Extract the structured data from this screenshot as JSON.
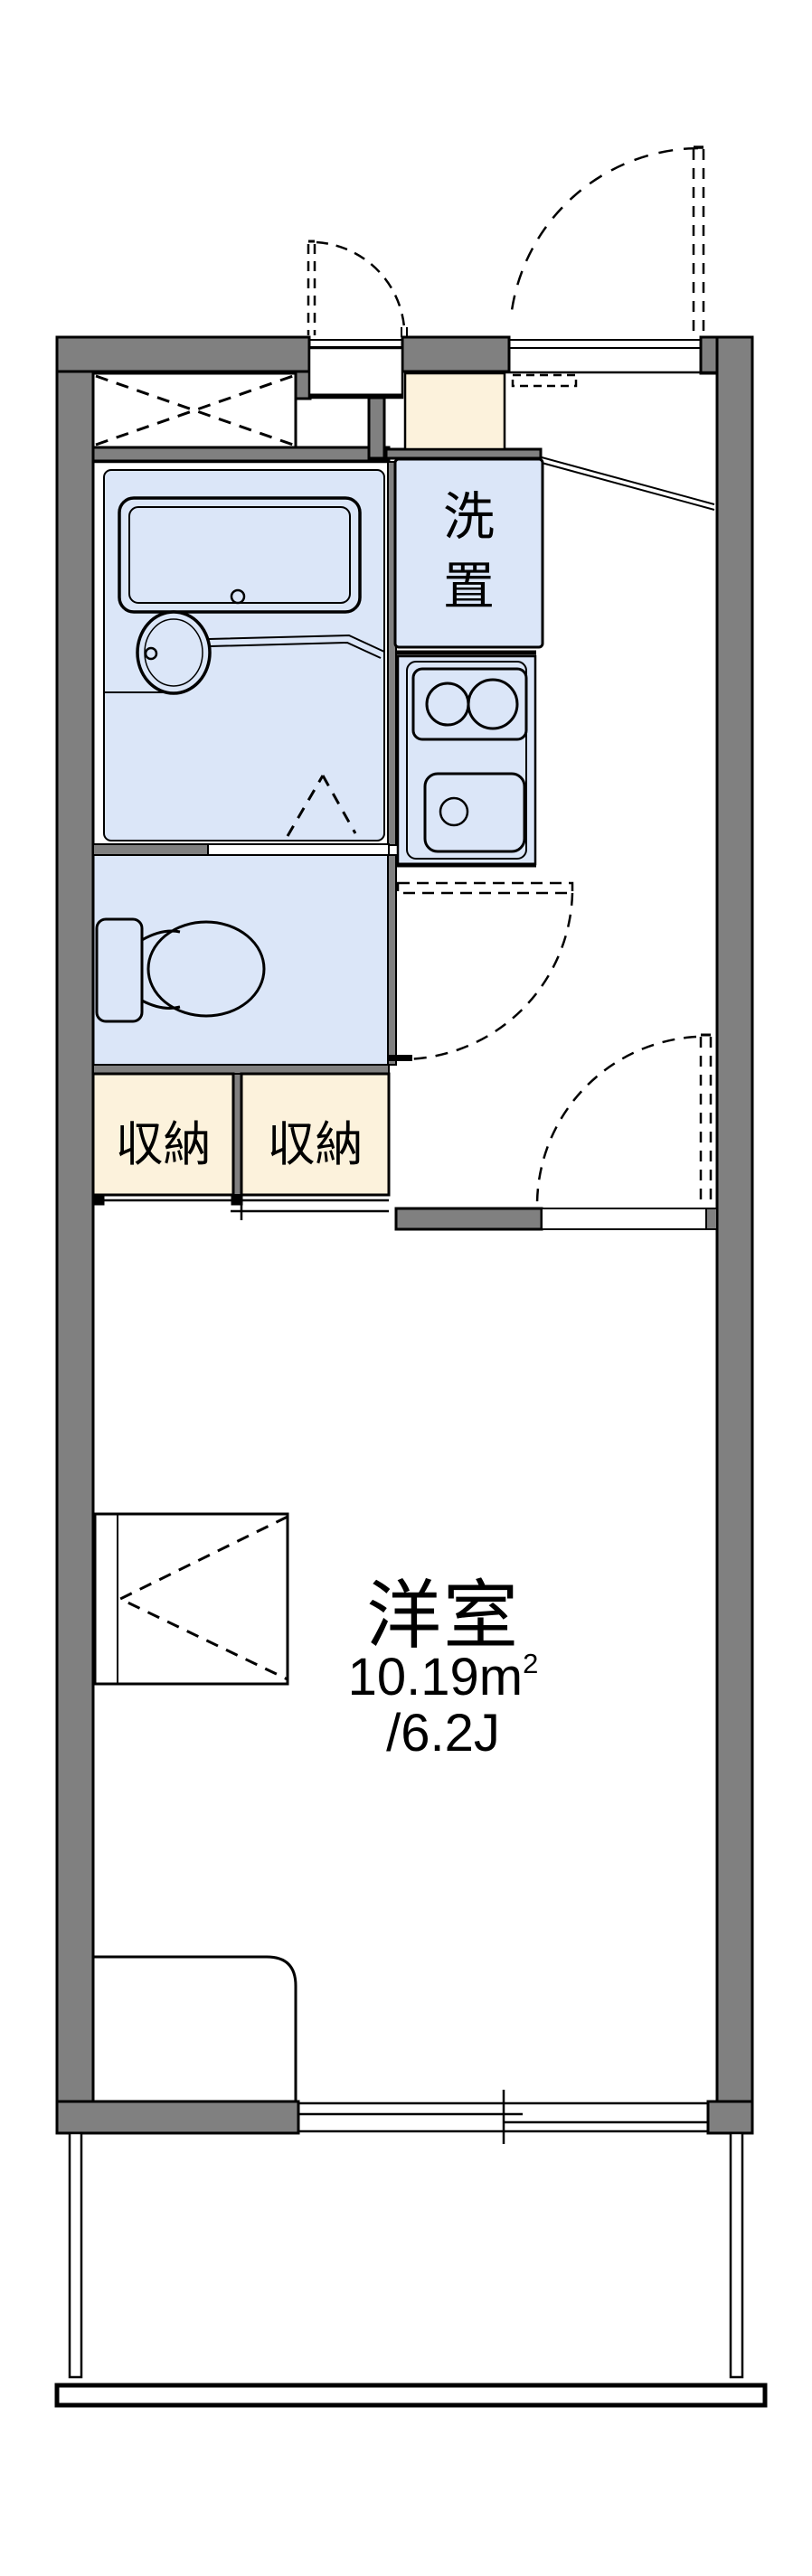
{
  "floorplan": {
    "kind": "japanese-apartment-floor-plan",
    "colors": {
      "wall_fill": "#808080",
      "outline": "#000000",
      "water_area_fill": "#dbe6f8",
      "storage_fill": "#fcf2dc",
      "floor_fill": "#ffffff"
    },
    "rooms": {
      "washer_space": {
        "label_vertical": [
          "洗",
          "置"
        ]
      },
      "storage_left": {
        "label": "収納"
      },
      "storage_right": {
        "label": "収納"
      },
      "western_room": {
        "label": "洋室",
        "area_sqm": "10.19",
        "area_sqm_unit": "m",
        "area_sqm_sup": "2",
        "area_tatami": "/6.2J"
      }
    },
    "fixtures": [
      "bathtub",
      "washbasin",
      "toilet",
      "two-burner-stove",
      "kitchen-sink",
      "entry-step",
      "shoe-closet-x",
      "desk",
      "bed",
      "entry-door-swing",
      "interior-door-swings",
      "sliding-doors",
      "sliding-window",
      "balcony-railing"
    ]
  }
}
